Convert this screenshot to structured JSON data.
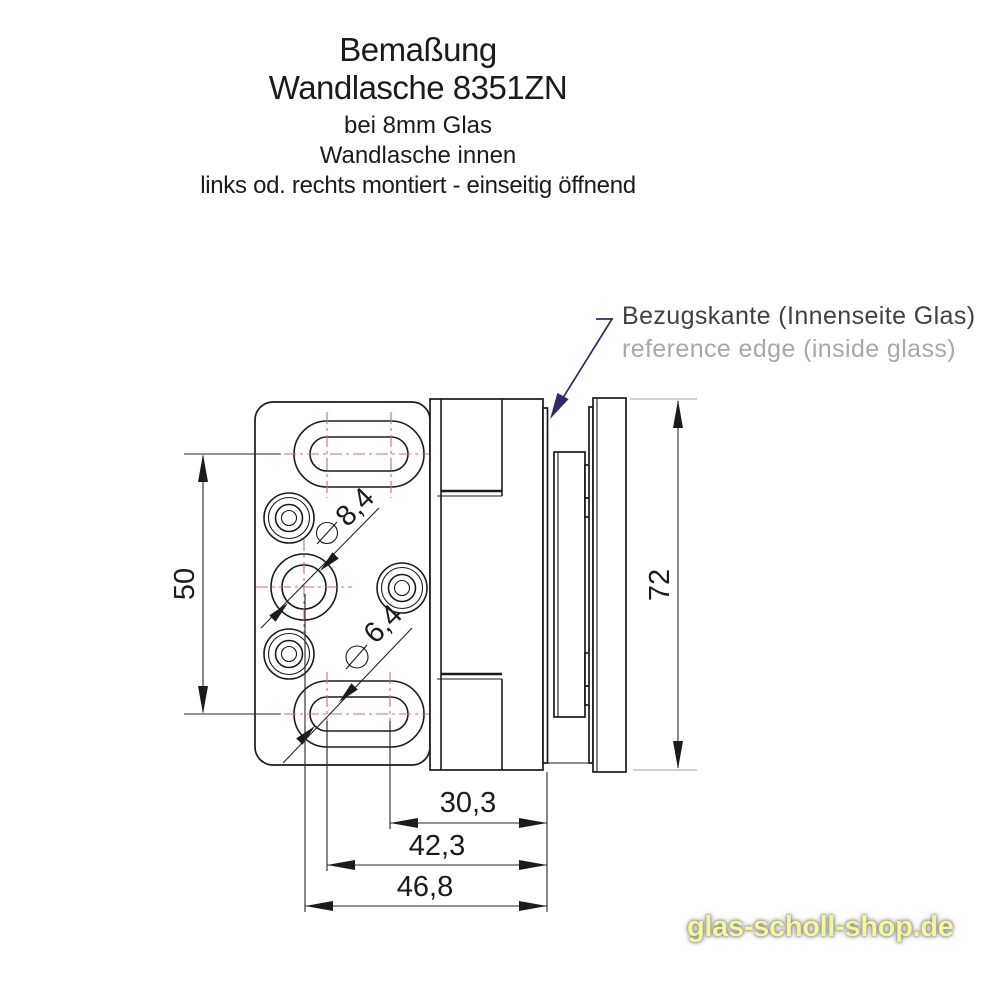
{
  "title": {
    "line1": "Bemaßung",
    "line2": "Wandlasche 8351ZN",
    "line3": "bei 8mm Glas",
    "line4": "Wandlasche innen",
    "line5": "links od. rechts montiert - einseitig öffnend"
  },
  "callout": {
    "de": "Bezugskante (Innenseite Glas)",
    "en": "reference edge (inside glass)"
  },
  "dims": {
    "slot_spacing": "50",
    "total_height": "72",
    "hole_large": "8,4",
    "hole_small": "6,4",
    "offset_short": "30,3",
    "offset_mid": "42,3",
    "offset_long": "46,8"
  },
  "watermark": {
    "text": "glas-scholl-shop.de"
  },
  "colors": {
    "drawing_line": "#1b1b1b",
    "centerline_red": "#d96a6a",
    "leader_navy": "#2d2d66",
    "secondary_text_gray": "#a8a8a8",
    "watermark_yellow": "#f5f59c"
  }
}
